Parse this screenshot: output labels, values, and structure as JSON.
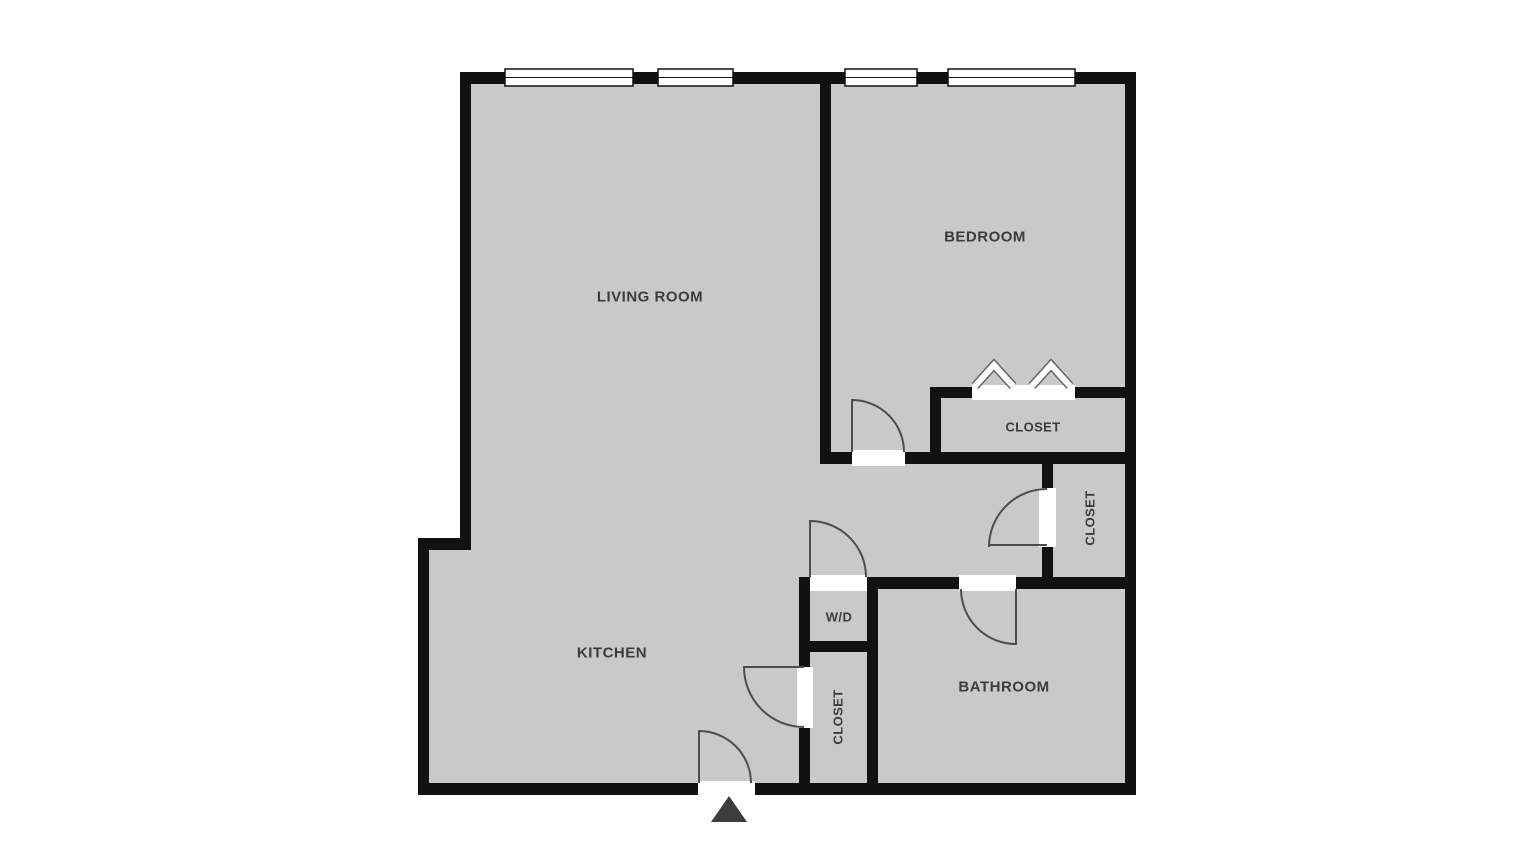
{
  "diagram_title": "apartment-floor-plan",
  "rooms": {
    "living_room": {
      "label": "LIVING ROOM"
    },
    "bedroom": {
      "label": "BEDROOM"
    },
    "bedroom_closet": {
      "label": "CLOSET"
    },
    "hall_closet": {
      "label": "CLOSET"
    },
    "washer_dryer": {
      "label": "W/D"
    },
    "kitchen": {
      "label": "KITCHEN"
    },
    "kitchen_closet": {
      "label": "CLOSET"
    },
    "bathroom": {
      "label": "BATHROOM"
    }
  },
  "colors": {
    "background": "#ffffff",
    "floor_fill": "#c9c9c9",
    "wall": "#111111",
    "opening": "#ffffff",
    "door_swing_stroke": "#4d4d4d",
    "label_text": "#3c3c3c",
    "entrance_marker": "#3d3d3d",
    "rod_symbol_outline": "#666666"
  },
  "symbols": {
    "entrance_marker_icon": "triangle-up",
    "closet_rod_icon": "chevron-up",
    "window_icon": "double-line-window",
    "door_icon": "quarter-arc-swing"
  }
}
